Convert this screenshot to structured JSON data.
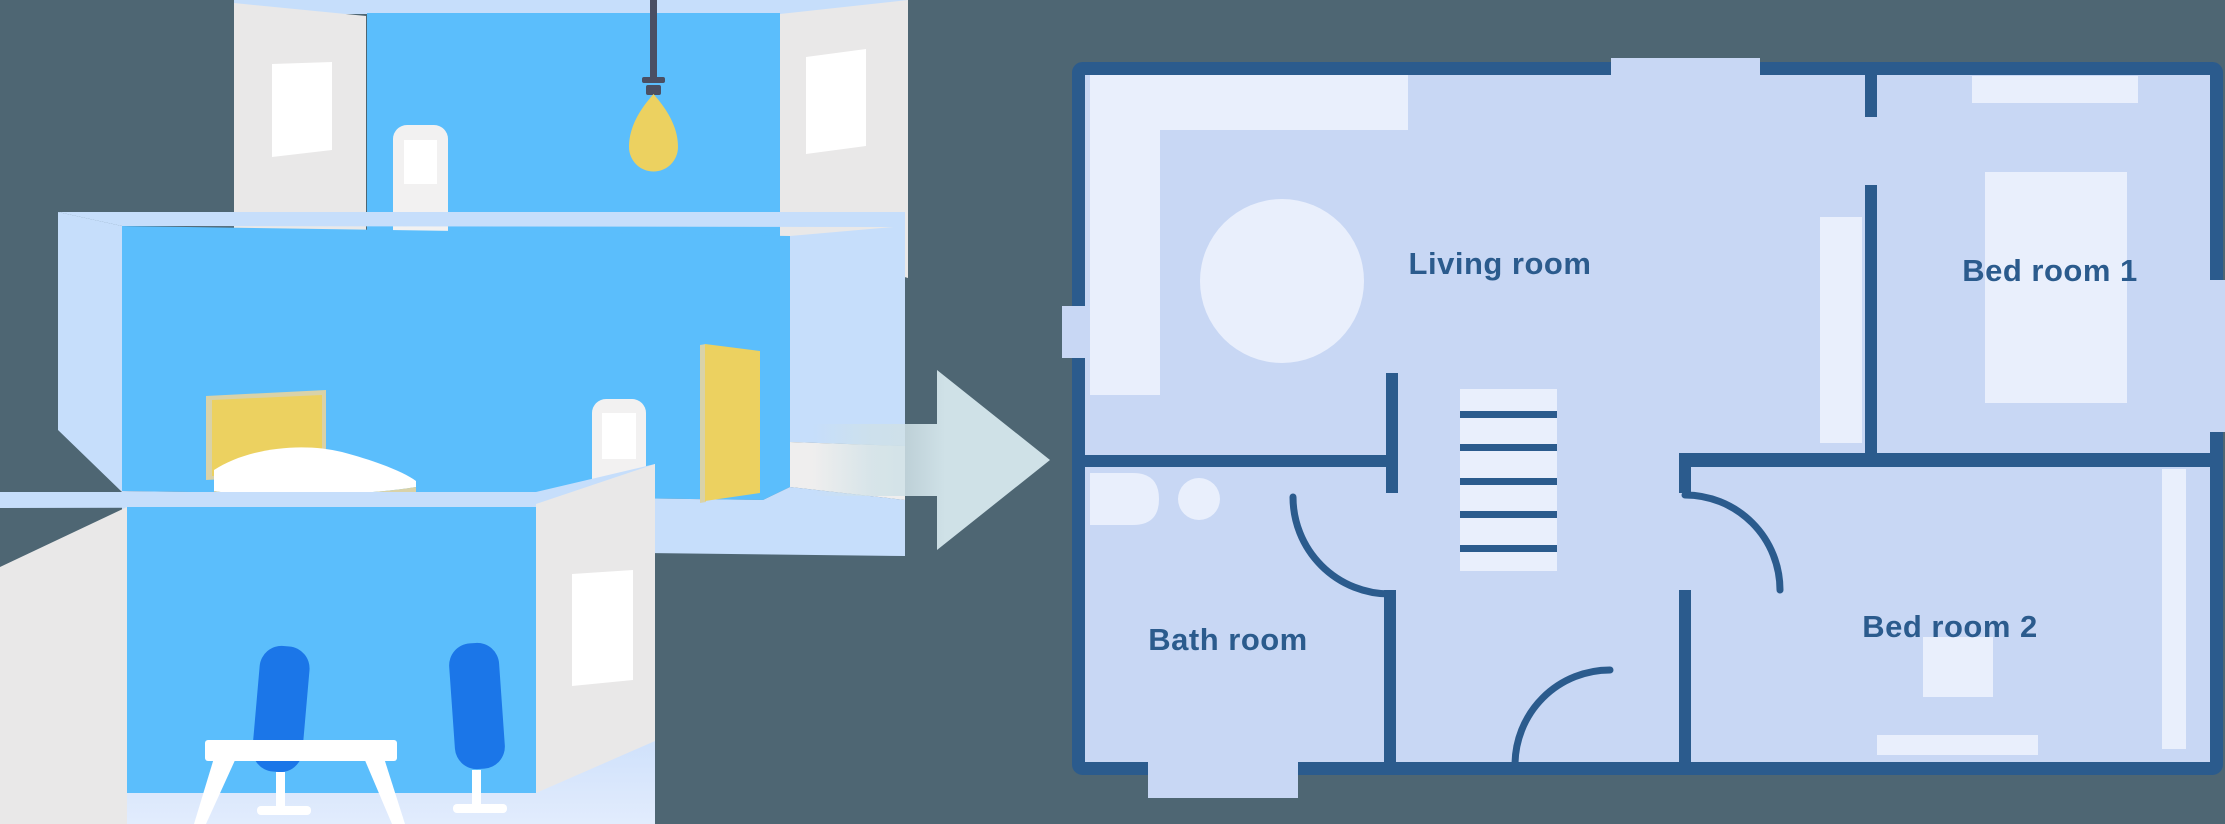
{
  "title": "House rooms transformed into a floor plan",
  "colors": {
    "background": "#4e6673",
    "wall": "#2b5b8d",
    "floor": "#c8d7f4",
    "furniture": "#e9effc",
    "room_blue": "#5bbefc",
    "room_pale": "#c6defb",
    "side_wall": "#e9e8e8",
    "pure_white": "#ffffff",
    "accent_yellow": "#ecd160",
    "cord_dark": "#4a4f63",
    "chair_blue": "#1b76e8",
    "arrow": "#cfe1e7",
    "bed_trim": "#d9d2a8",
    "floor_deep": "#cfe1fb",
    "floor_light": "#e2ecfd"
  },
  "illustration": {
    "rooms": [
      {
        "name": "room-with-pendant-light"
      },
      {
        "name": "bedroom-with-bed-and-yellow-door"
      },
      {
        "name": "dining-room-with-table-and-chairs"
      }
    ]
  },
  "arrow": {
    "direction": "right"
  },
  "floor_plan": {
    "labels": {
      "living_room": "Living room",
      "bed_room_1": "Bed room 1",
      "bath_room": "Bath room",
      "bed_room_2": "Bed room 2"
    }
  }
}
